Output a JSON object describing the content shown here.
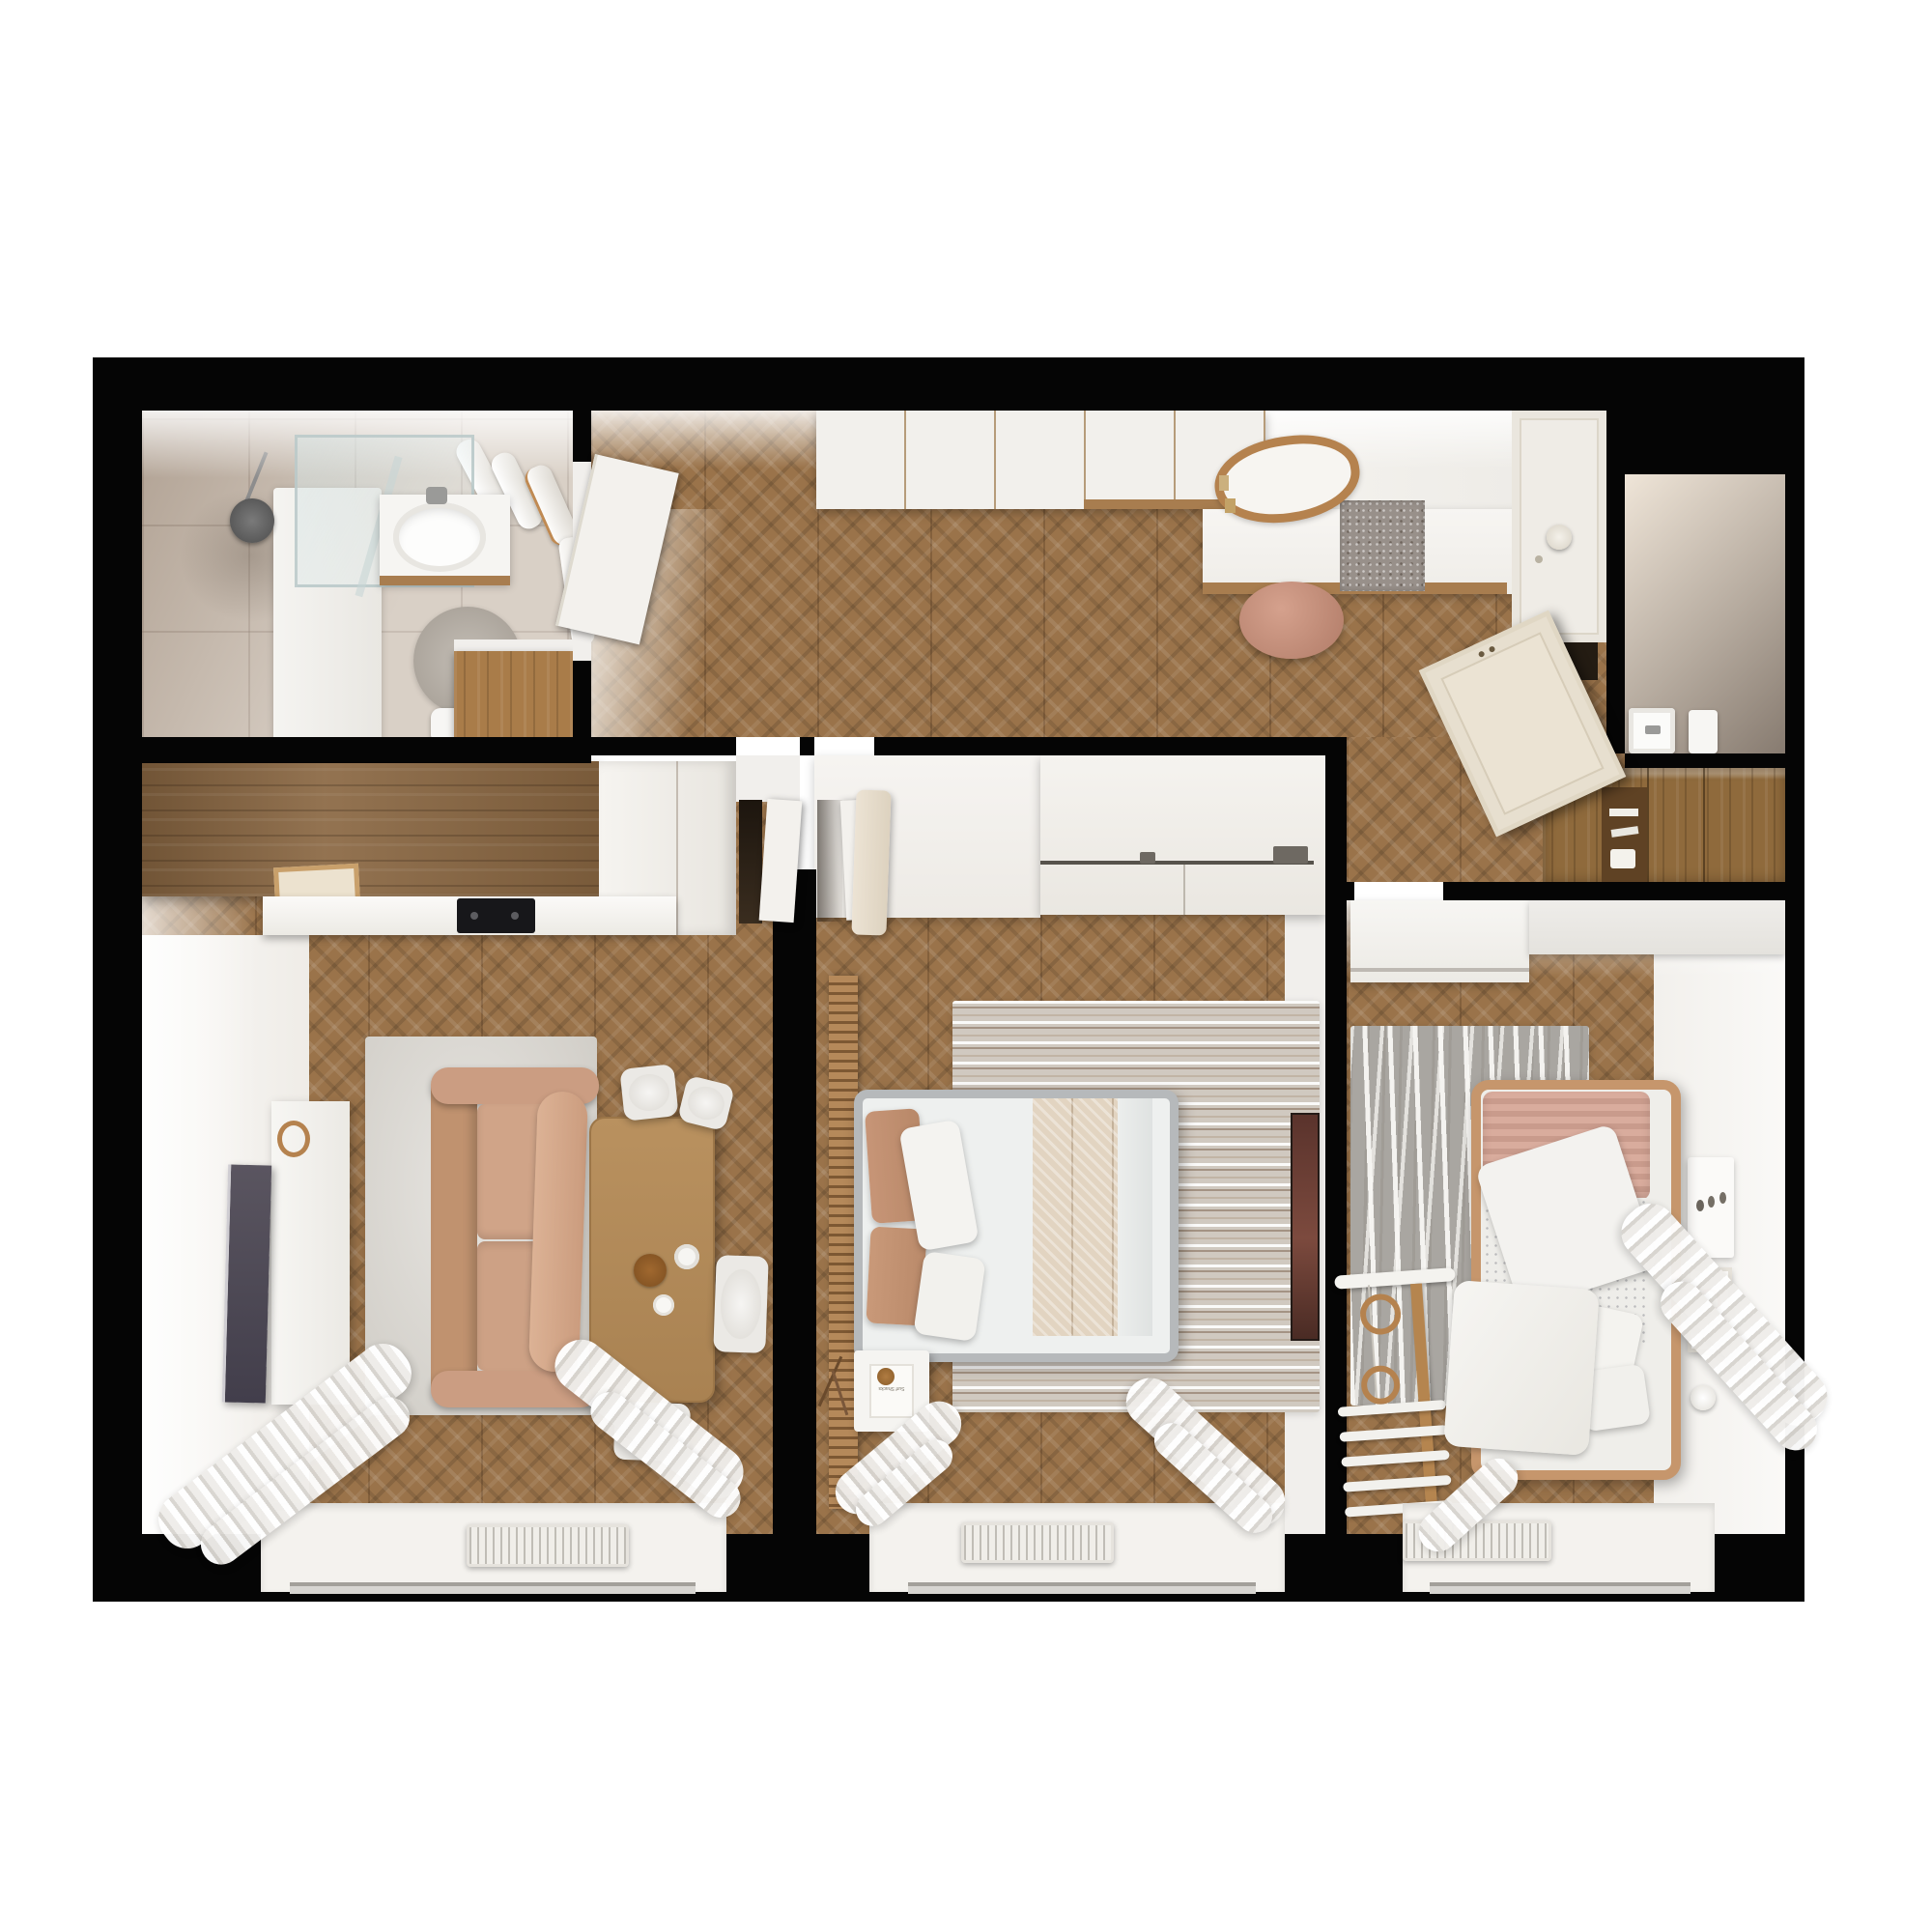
{
  "meta": {
    "description": "Photorealistic top-down 3D render of an apartment floor plan with black cut walls",
    "render_style": "dollhouse top view"
  },
  "palette": {
    "background": "#ffffff",
    "walls": "#050505",
    "wood_floor": "#9a734a",
    "tile_floor": "#c9bcae",
    "white_furniture": "#f1efec",
    "oak_cabinet": "#8f6a3c",
    "kitchen_slab": "#8a6742",
    "sofa": "#cb9d82",
    "accent_salmon": "#c08f70",
    "living_rug": "#dcd9d4",
    "bedroom_rug_base": "#d0c9c0",
    "kids_rug": "#a9a6a1",
    "table_wood": "#b28a5b",
    "tv_screen": "#4b4754",
    "mirror_ring": "#b5824e",
    "entry_door_cream": "#ebe3d3",
    "cooktop": "#17171a",
    "bed_frame_gray": "#b6b9bb",
    "kids_bed_frame": "#c6966c"
  },
  "rooms": [
    {
      "name": "bathroom",
      "features": [
        "shower",
        "double-sink-vanity",
        "towel-rail",
        "round-rug",
        "wood-dresser",
        "toilet"
      ]
    },
    {
      "name": "hallway-entry",
      "features": [
        "wardrobe",
        "console-desk",
        "oval-mirror",
        "pouf",
        "doormat",
        "front-door",
        "oak-shelving"
      ]
    },
    {
      "name": "wc",
      "features": [
        "small-sink",
        "fixture"
      ]
    },
    {
      "name": "living-room-kitchen",
      "features": [
        "kitchen-counter",
        "cooktop",
        "tv",
        "tv-stand",
        "sofa",
        "dining-table",
        "chairs",
        "rug",
        "window",
        "radiator",
        "curtains"
      ]
    },
    {
      "name": "bedroom",
      "features": [
        "sliding-wardrobe",
        "double-bed",
        "slat-panel",
        "striped-rug",
        "nightstand",
        "wall-art",
        "window",
        "radiator",
        "curtains"
      ]
    },
    {
      "name": "kids-room",
      "features": [
        "wall-cabinet",
        "desk-shelf",
        "single-bed",
        "wavy-rug",
        "gym-ladder",
        "gymnastic-rings",
        "socket-panel",
        "wall-frame",
        "window",
        "radiator",
        "curtains"
      ]
    }
  ],
  "decor": {
    "book_title": "Surf Shacks"
  }
}
